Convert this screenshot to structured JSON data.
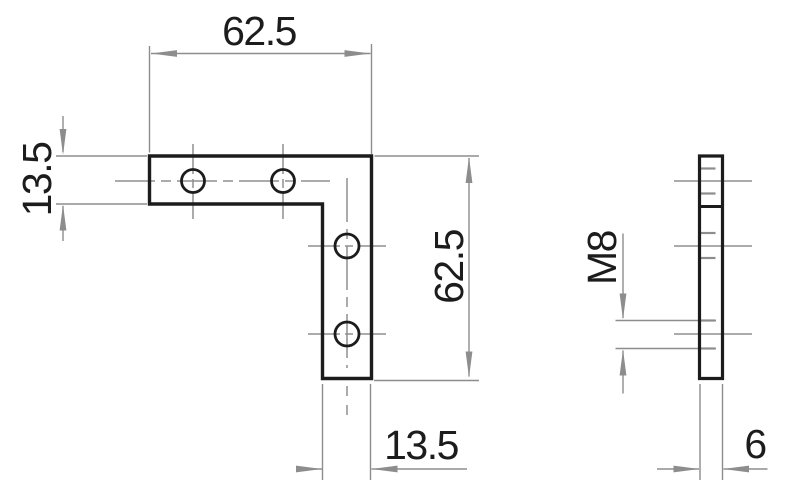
{
  "drawing": {
    "type": "technical dimension drawing",
    "part": "L-shaped corner bracket, front view and side view",
    "front_view": {
      "dim_top_width": "62.5",
      "dim_left_thickness": "13.5",
      "dim_right_height": "62.5",
      "dim_bottom_thickness": "13.5"
    },
    "side_view": {
      "dim_thread": "M8",
      "dim_thickness": "6"
    },
    "colors": {
      "outline": "#1c1c1c",
      "dimension_lines": "#8d8d8d",
      "background": "#ffffff"
    }
  }
}
